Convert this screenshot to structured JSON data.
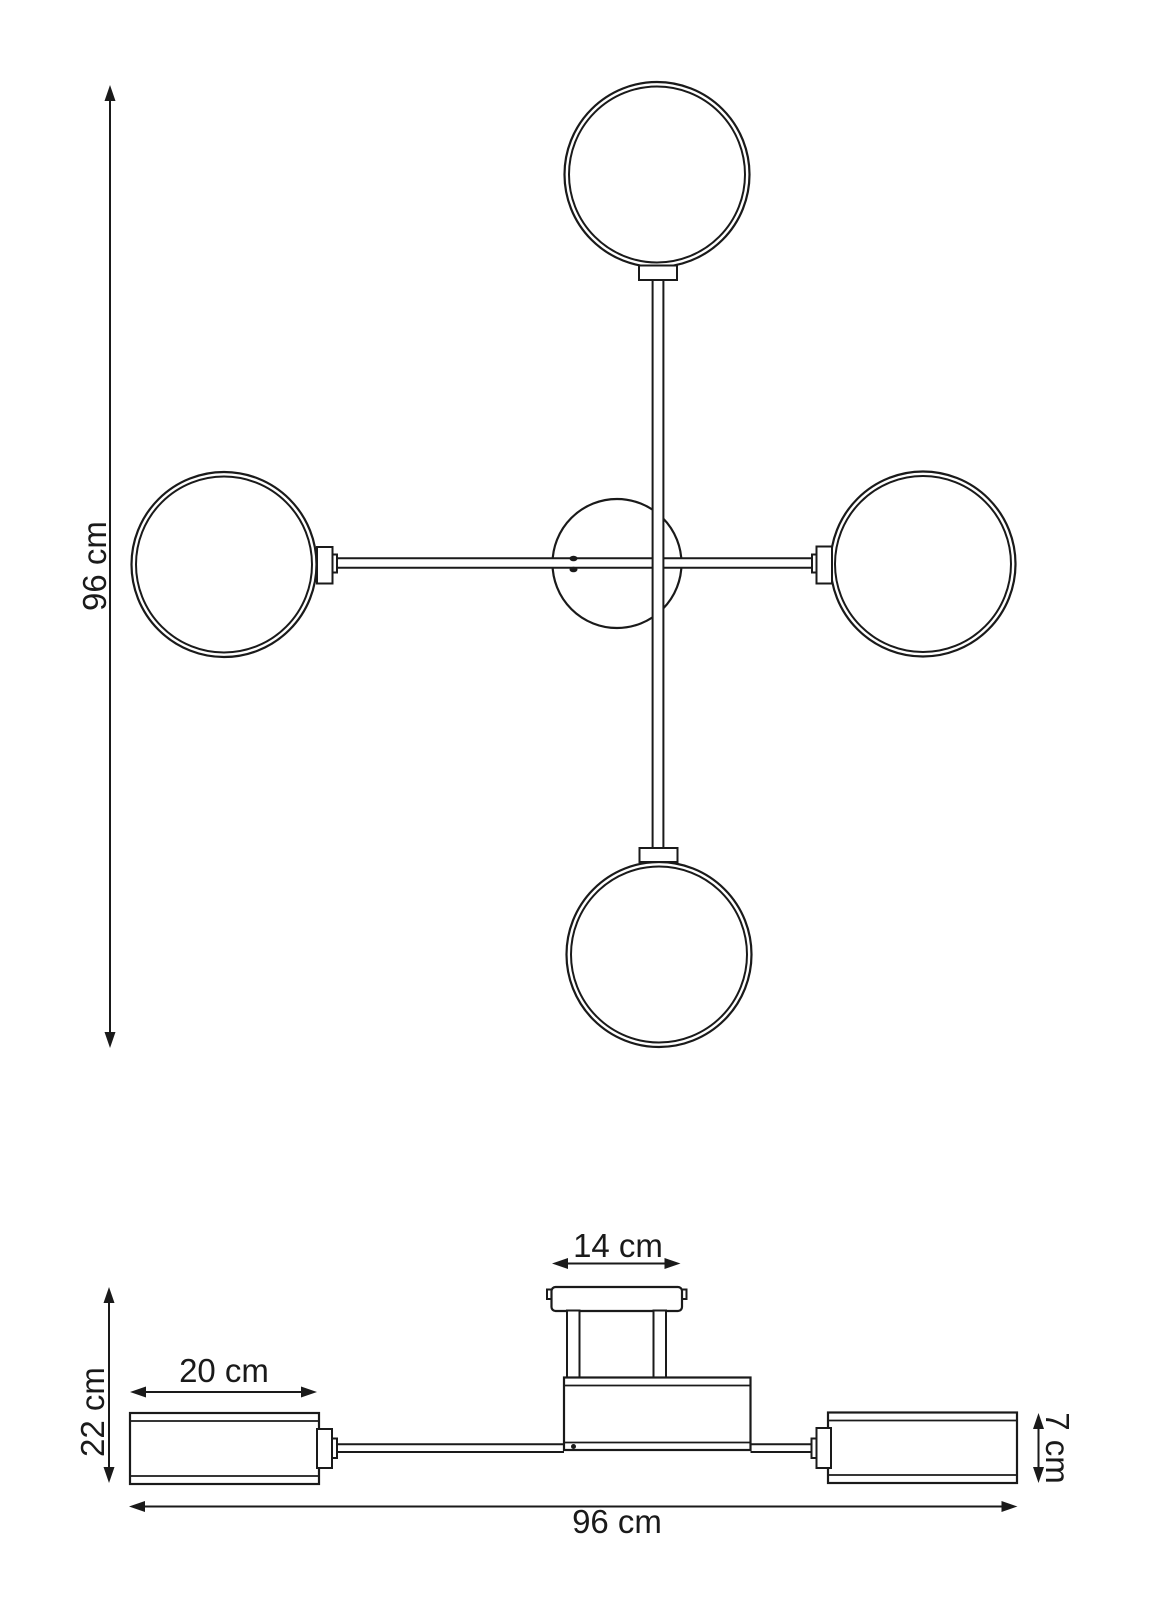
{
  "drawing": {
    "background_color": "#ffffff",
    "line_color": "#1a1a1a",
    "views": {
      "top_view": {
        "dim_height_label": "96 cm"
      },
      "side_view": {
        "dim_canopy_width_label": "14 cm",
        "dim_height_label": "22 cm",
        "dim_shade_length_label": "20 cm",
        "dim_shade_height_label": "7 cm",
        "dim_total_width_label": "96 cm"
      }
    }
  }
}
